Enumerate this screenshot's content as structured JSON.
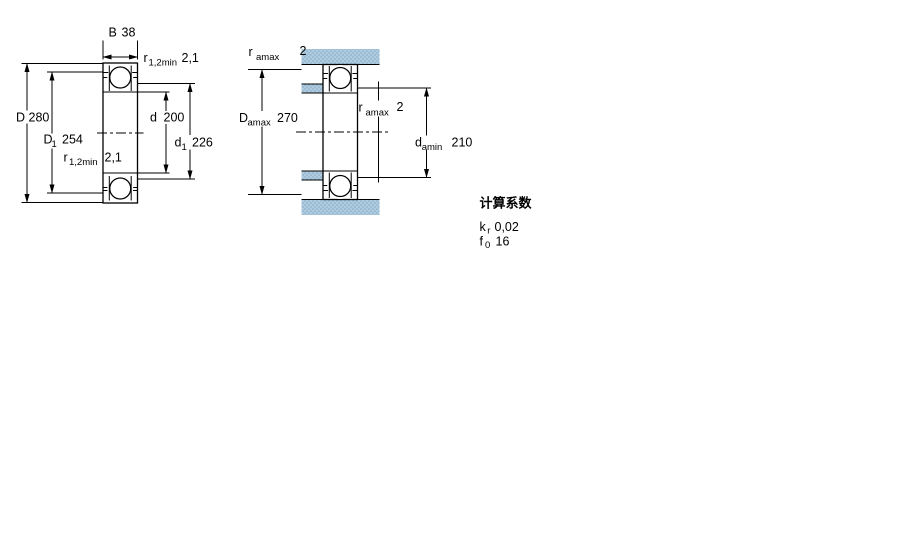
{
  "drawing": {
    "description_colors": {
      "hatch_base": "#aecbdf",
      "hatch_dot": "#82a8c2",
      "line": "#000000"
    }
  },
  "left_view": {
    "b": {
      "base": "B",
      "value": "38"
    },
    "r_top": {
      "base": "r",
      "sub": "1,2min",
      "value": "2,1"
    },
    "dim_D": {
      "base": "D",
      "value": "280"
    },
    "dim_D1": {
      "base": "D",
      "sub": "1",
      "value": "254"
    },
    "dim_d": {
      "base": "d",
      "value": "200"
    },
    "dim_d1": {
      "base": "d",
      "sub": "1",
      "value": "226"
    },
    "r_bottom": {
      "base": "r",
      "sub": "1,2min",
      "value": "2,1"
    }
  },
  "right_view": {
    "r_top": {
      "base": "r",
      "sub": "amax",
      "value": "2"
    },
    "dim_Damax": {
      "base": "D",
      "sub": "amax",
      "value": "270"
    },
    "r_mid": {
      "base": "r",
      "sub": "amax",
      "value": "2"
    },
    "dim_damin": {
      "base": "d",
      "sub": "amin",
      "value": "210"
    }
  },
  "factors": {
    "title": "计算系数",
    "rows": [
      {
        "base": "k",
        "sub": "r",
        "value": "0,02"
      },
      {
        "base": "f",
        "sub": "0",
        "value": "16"
      }
    ]
  }
}
